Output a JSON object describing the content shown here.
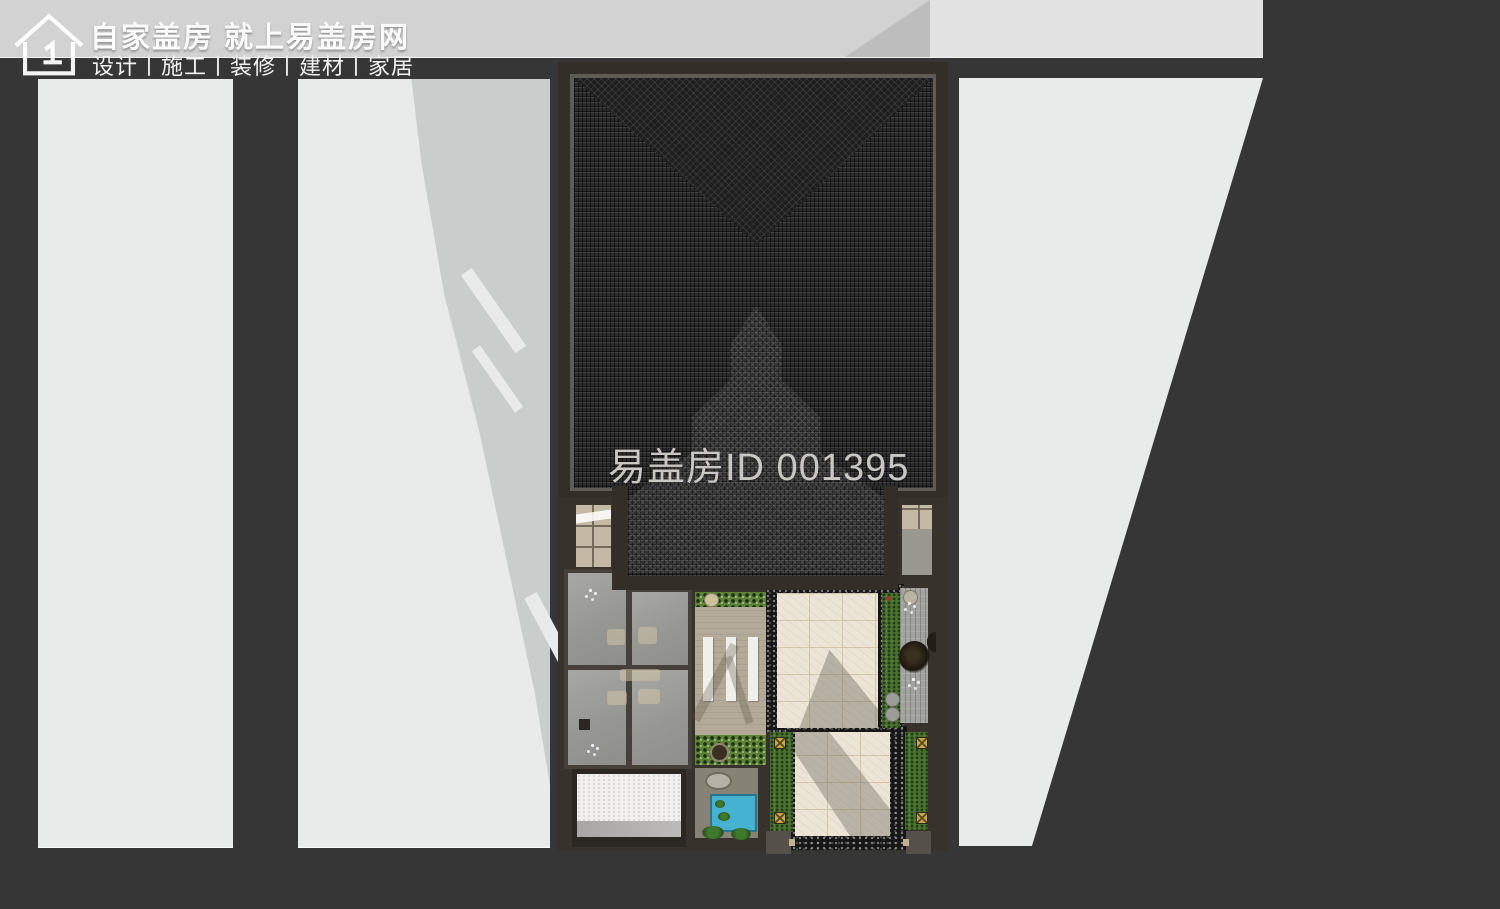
{
  "brand": {
    "tagline": "自家盖房 就上易盖房网",
    "services": "设计丨施工丨装修丨建材丨家居",
    "logo_icon": "house-outline-icon"
  },
  "watermark": {
    "text": "易盖房ID 001395",
    "color": "#d6d4d0"
  },
  "palette": {
    "background": "#363636",
    "street_strip": "#d2d2d2",
    "street_strip_light": "#e2e2e2",
    "neighbor_plot": "#e9ebea",
    "cast_shadow": "#c9cdcc",
    "roof_frame": "#332e28",
    "roof_tile": "#2b2b2b",
    "gravel": "#161616",
    "marble_path": "#ece5d7",
    "lawn": "#4a7330",
    "grass_paver": "#5d8238",
    "timber_patio": "#b3aa99",
    "wood_deck": "#a2a29e",
    "glass_room": "#979794",
    "garage_pad": "#f1f0ee",
    "pool_water": "#45b2d2",
    "gold_light": "#c9a54e"
  },
  "scene": {
    "type": "top-down architectural rendering of a courtyard house",
    "regions": [
      "street-strip",
      "neighbor-plot-left",
      "neighbor-plot-middle",
      "neighbor-plot-right",
      "building-cast-shadow",
      "main-tiled-roof",
      "roof-valley-pattern",
      "roof-chevron-pattern",
      "entry-roof-tongue",
      "skylight-left",
      "skylight-right",
      "glass-atrium-rooms",
      "garage-pad",
      "grass-paver-strips",
      "timber-patio",
      "pergola-slats",
      "round-planter",
      "plunge-pool",
      "tea-table",
      "marble-walkway-upper",
      "marble-walkway-lower",
      "lawn-strips",
      "wood-deck",
      "landscape-tree",
      "ground-lights",
      "gate-pillars",
      "gravel-borders"
    ]
  }
}
